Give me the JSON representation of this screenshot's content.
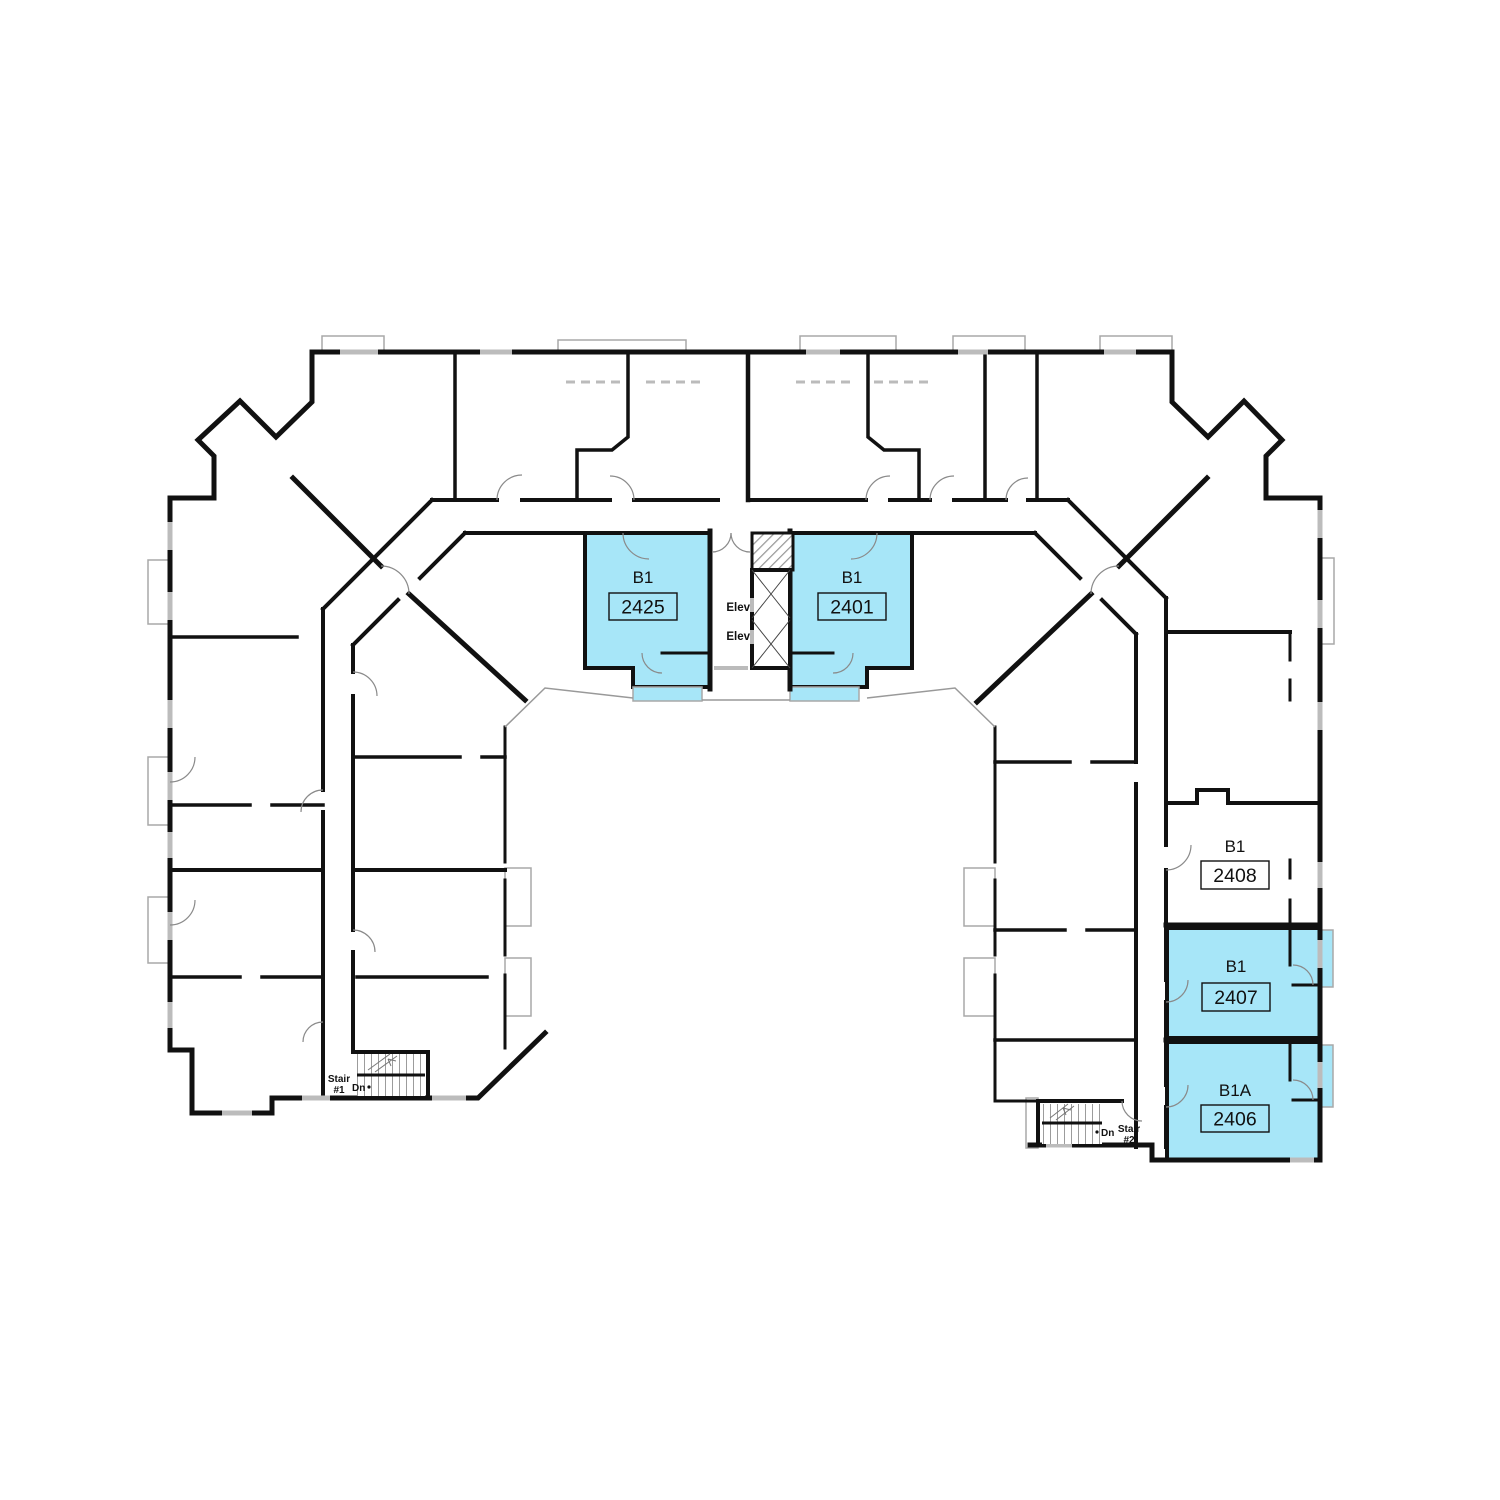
{
  "floorplan": {
    "units": [
      {
        "type_label": "B1",
        "number": "2425",
        "highlighted": true
      },
      {
        "type_label": "B1",
        "number": "2401",
        "highlighted": true
      },
      {
        "type_label": "B1",
        "number": "2408",
        "highlighted": false
      },
      {
        "type_label": "B1",
        "number": "2407",
        "highlighted": true
      },
      {
        "type_label": "B1A",
        "number": "2406",
        "highlighted": true
      }
    ],
    "elevators": {
      "labels": [
        "Elev",
        "Elev"
      ]
    },
    "stairs": [
      {
        "name": "Stair",
        "number": "#1",
        "direction": "Dn"
      },
      {
        "name": "Stair",
        "number": "#2",
        "direction": "Dn"
      }
    ],
    "colors": {
      "unit_highlight": "#A7E6F8",
      "wall": "#111111"
    }
  }
}
